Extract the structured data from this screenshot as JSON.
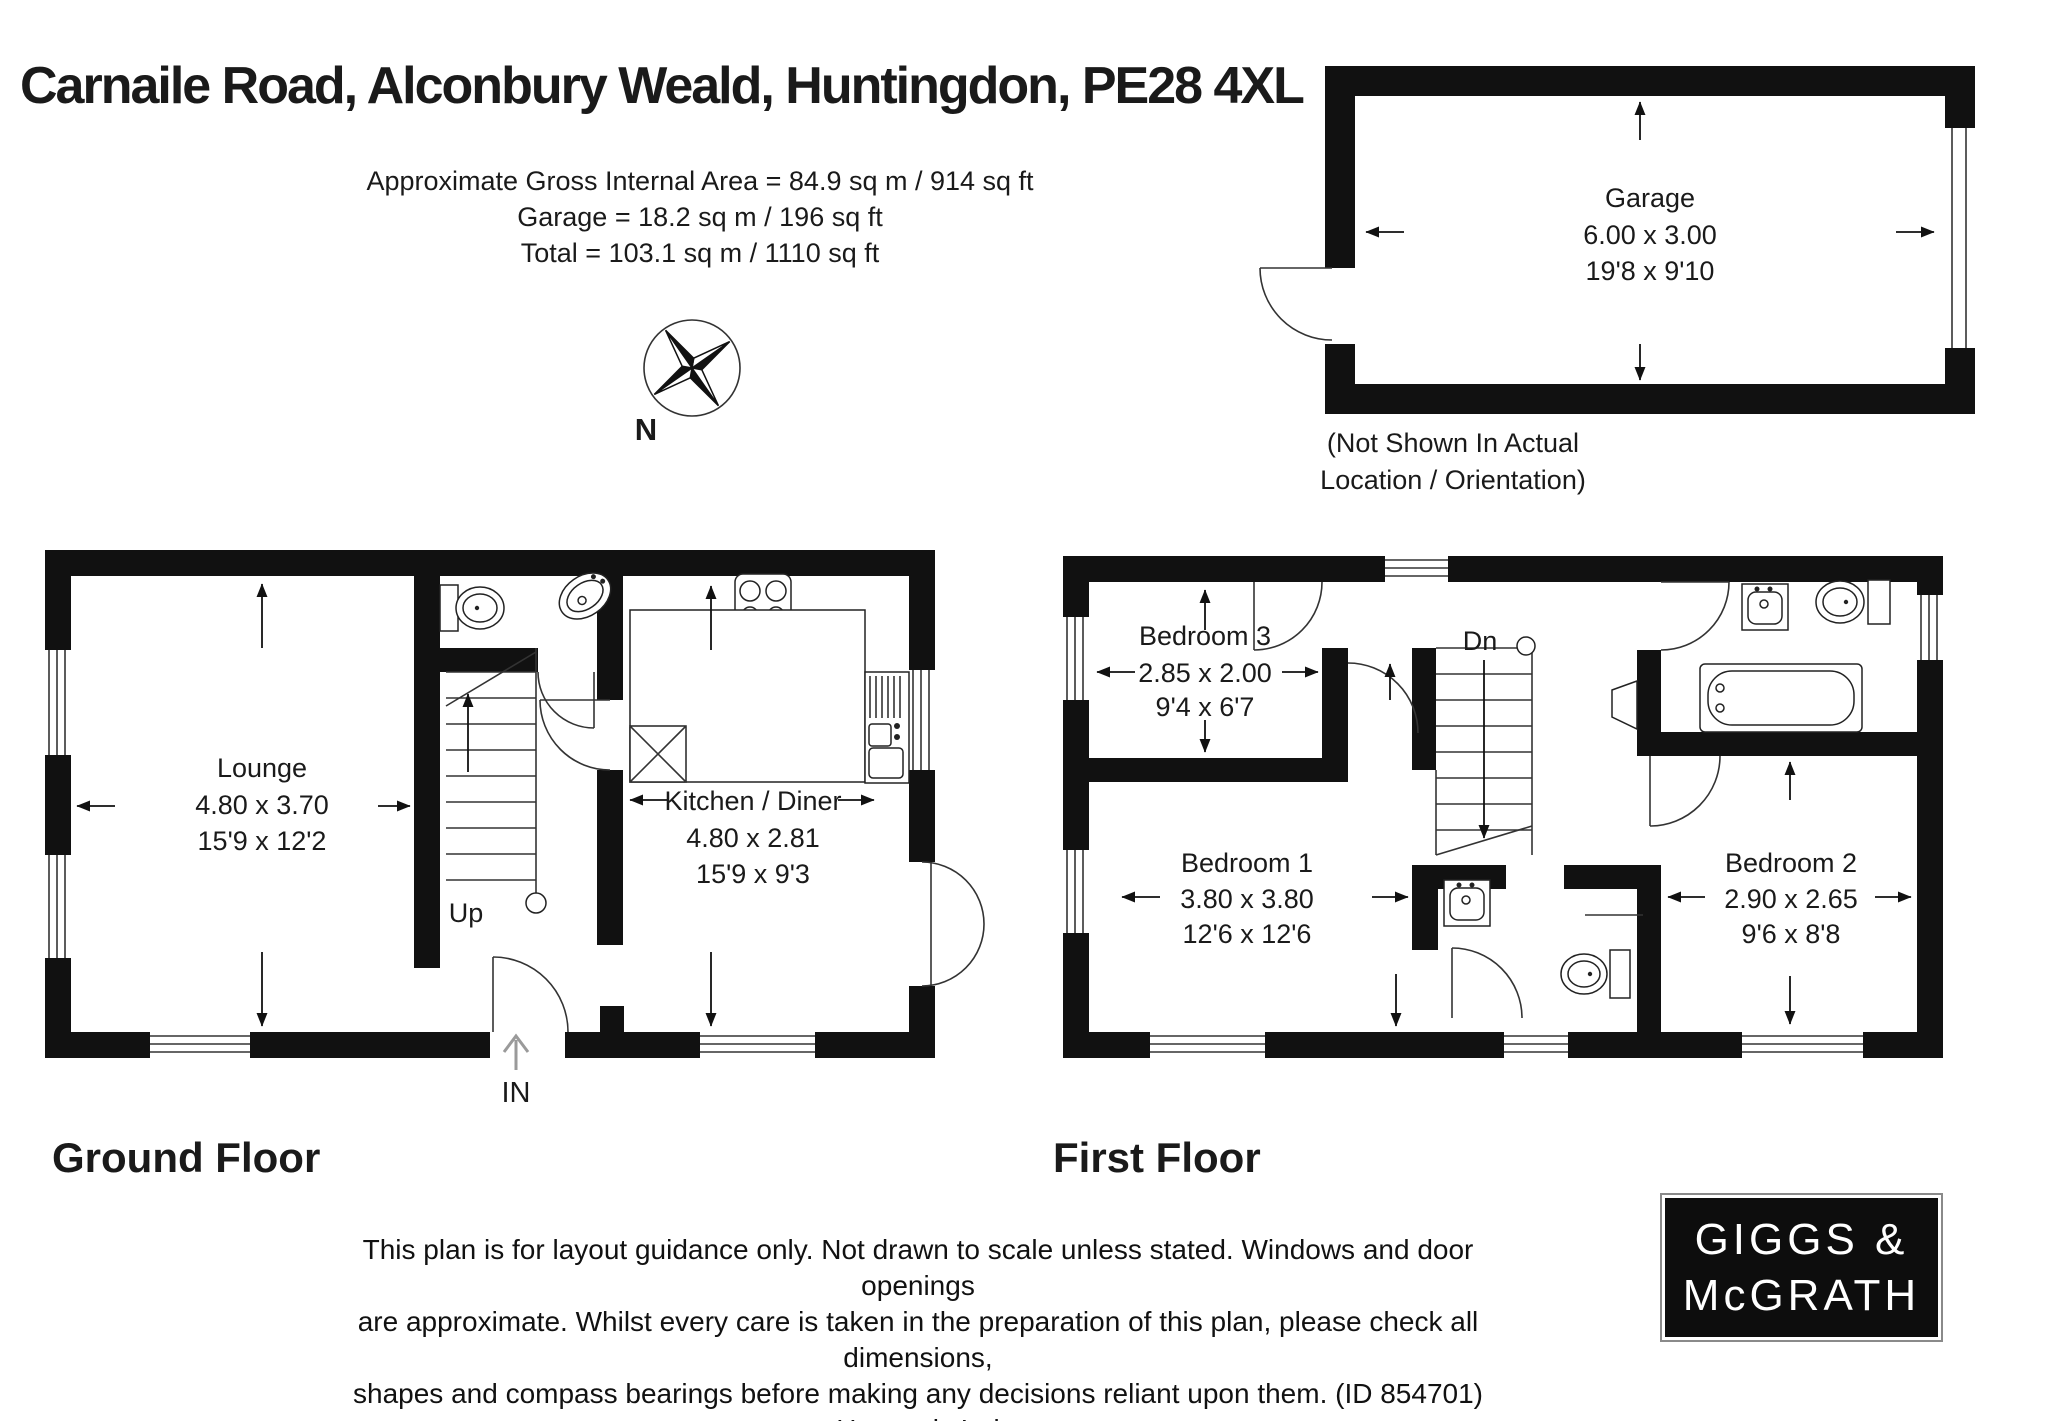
{
  "header": {
    "title": "Carnaile Road, Alconbury Weald, Huntingdon, PE28 4XL",
    "area_lines": [
      "Approximate Gross Internal Area = 84.9 sq m / 914 sq ft",
      "Garage = 18.2 sq m / 196 sq ft",
      "Total = 103.1 sq m / 1110 sq ft"
    ]
  },
  "compass": {
    "north_label": "N"
  },
  "garage": {
    "name": "Garage",
    "dim_m": "6.00 x 3.00",
    "dim_ft": "19'8 x 9'10",
    "note_line1": "(Not Shown In Actual",
    "note_line2": "Location / Orientation)"
  },
  "ground_floor": {
    "label": "Ground Floor",
    "lounge": {
      "name": "Lounge",
      "dim_m": "4.80 x 3.70",
      "dim_ft": "15'9 x 12'2"
    },
    "kitchen": {
      "name": "Kitchen / Diner",
      "dim_m": "4.80 x 2.81",
      "dim_ft": "15'9 x 9'3"
    },
    "stairs_label": "Up",
    "entrance_label": "IN"
  },
  "first_floor": {
    "label": "First Floor",
    "bedroom1": {
      "name": "Bedroom 1",
      "dim_m": "3.80 x 3.80",
      "dim_ft": "12'6 x 12'6"
    },
    "bedroom2": {
      "name": "Bedroom 2",
      "dim_m": "2.90 x 2.65",
      "dim_ft": "9'6 x 8'8"
    },
    "bedroom3": {
      "name": "Bedroom 3",
      "dim_m": "2.85 x 2.00",
      "dim_ft": "9'4 x 6'7"
    },
    "stairs_label": "Dn"
  },
  "footer": {
    "disclaimer_lines": [
      "This plan is for layout guidance only. Not drawn to scale unless stated. Windows and door openings",
      "are approximate. Whilst every care is taken in the preparation of this plan, please check all dimensions,",
      "shapes and compass bearings before making any decisions reliant upon them. (ID 854701)",
      "Housepix Ltd"
    ]
  },
  "logo": {
    "line1": "GIGGS &",
    "line2": "McGRATH",
    "bg": "#0d0d0d",
    "fg": "#ffffff"
  },
  "colors": {
    "wall": "#111111",
    "line": "#222222",
    "in_arrow": "#9a9a9a"
  }
}
